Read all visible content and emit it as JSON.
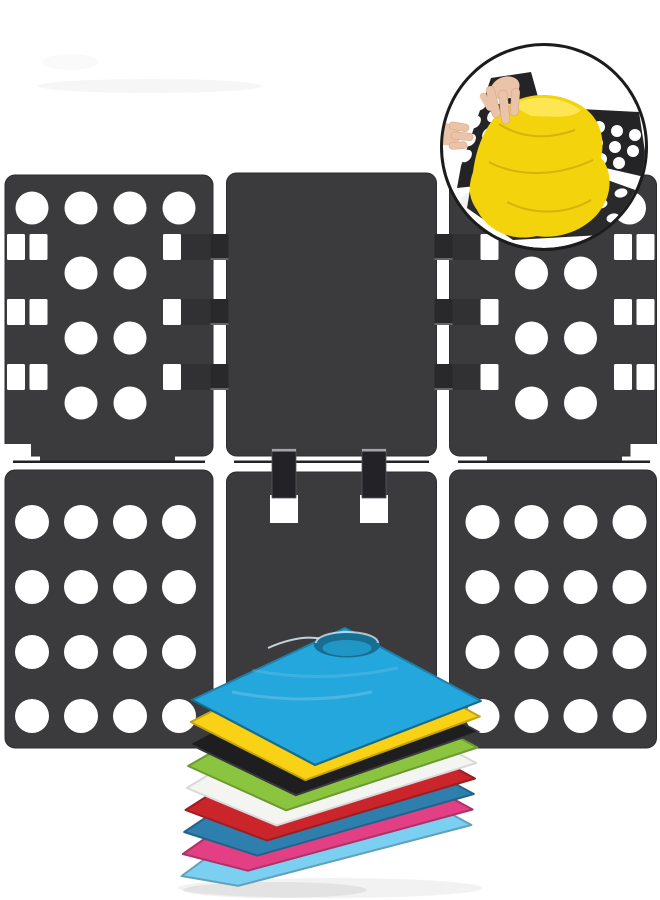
{
  "scene": {
    "type": "product-photo",
    "subject": "adjustable clothes folding board with stacked folded t-shirts and usage inset",
    "background_color": "#ffffff"
  },
  "board": {
    "panel_color": "#3b3b3e",
    "panel_edge_color": "#2c2c2f",
    "hinge_root_color": "#313134",
    "hinge_color": "#29292c",
    "hook_color": "#232327",
    "hook_highlight_color": "#a5a5a8",
    "hole_color": "#ffffff",
    "fold_line_color": "#232326",
    "layout": {
      "rows": 2,
      "columns": 3,
      "hook_count": 2
    },
    "panels": [
      {
        "id": "top-left",
        "type": "perforated"
      },
      {
        "id": "top-center",
        "type": "solid"
      },
      {
        "id": "top-right",
        "type": "perforated"
      },
      {
        "id": "bottom-left",
        "type": "perforated"
      },
      {
        "id": "bottom-center",
        "type": "solid-with-hooks"
      },
      {
        "id": "bottom-right",
        "type": "perforated"
      }
    ]
  },
  "shirt_stack": {
    "count": 9,
    "shadow_color": "#000000",
    "shirts": [
      {
        "position": 1,
        "color_name": "cyan-blue",
        "hex": "#24a7dc"
      },
      {
        "position": 2,
        "color_name": "yellow",
        "hex": "#f9d215"
      },
      {
        "position": 3,
        "color_name": "black",
        "hex": "#1e1e20"
      },
      {
        "position": 4,
        "color_name": "apple-green",
        "hex": "#8bc53f"
      },
      {
        "position": 5,
        "color_name": "white",
        "hex": "#f4f4f1"
      },
      {
        "position": 6,
        "color_name": "red",
        "hex": "#c9252b"
      },
      {
        "position": 7,
        "color_name": "steel-blue",
        "hex": "#2e7fae"
      },
      {
        "position": 8,
        "color_name": "magenta-pink",
        "hex": "#e23f85"
      },
      {
        "position": 9,
        "color_name": "sky-blue",
        "hex": "#7bcff0"
      }
    ]
  },
  "inset": {
    "shape": "circle",
    "border_color": "#1c1c1c",
    "background_color": "#ffffff",
    "board_color": "#242427",
    "hole_color": "#ffffff",
    "shirt_color": "#f2d30c",
    "shirt_fold_color": "#c7a50a",
    "shirt_highlight_color": "#ffe95e",
    "hand_color": "#eac3a9",
    "hand_edge_color": "#d8a78b"
  }
}
